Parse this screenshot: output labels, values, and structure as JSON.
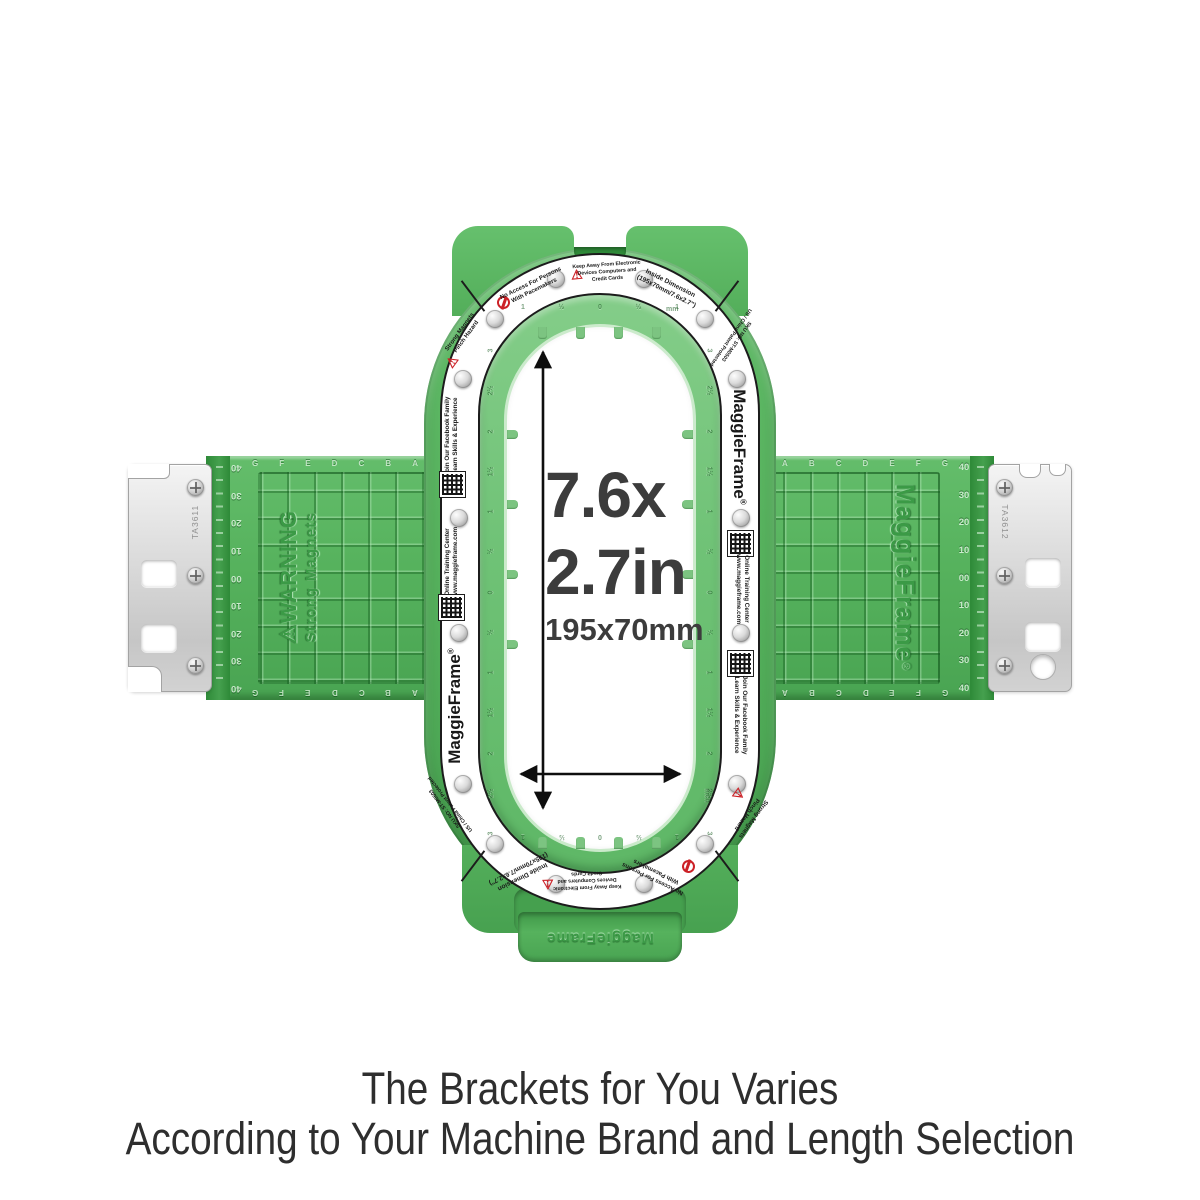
{
  "brand": "MaggieFrame",
  "reg": "®",
  "center_dimensions": {
    "line1": "7.6x",
    "line2": "2.7in",
    "line3": "195x70mm"
  },
  "caption": {
    "line1": "The Brackets for You Varies",
    "line2": "According to Your Machine Brand and Length Selection"
  },
  "ring": {
    "no_access": "No Access For Persons\nWith Pacemakers",
    "keep_away": "Keep Away From Electronic\nDevices Computers and\nCredit Cards",
    "inside_dimension": "Inside Dimension\n(195x70mm/7.6x2.7\")",
    "strong_magnets": "Strong Magnets\nPinch Hazard",
    "sku": "SKU NO: ST-M0503\nUS / China Patent Protected",
    "facebook": "Join Our Facebook Family\nLearn Skills & Experience",
    "training": "Online Training Center\nwww.maggieframe.com"
  },
  "lip_ruler": {
    "top": [
      "1",
      "½",
      "0",
      "½",
      "1"
    ],
    "bottom": [
      "1",
      "½",
      "0",
      "½",
      "1"
    ],
    "side": [
      "3",
      "2½",
      "2",
      "1½",
      "1",
      "½",
      "0",
      "½",
      "1",
      "1½",
      "2",
      "2½",
      "3"
    ],
    "unit_top": "mm",
    "unit_side": "inch"
  },
  "arms": {
    "warning_title": "WARNING",
    "warning_sub": "Strong Magnets",
    "ruler": [
      "40",
      "30",
      "20",
      "10",
      "00",
      "10",
      "20",
      "30",
      "40"
    ],
    "letters_left": [
      "G",
      "F",
      "E",
      "D",
      "C",
      "B",
      "A"
    ],
    "letters_right": [
      "A",
      "B",
      "C",
      "D",
      "E",
      "F",
      "G"
    ]
  },
  "brackets": {
    "left": "TA3611",
    "right": "TA3612"
  },
  "icons": {
    "warning_triangle": "⚠",
    "no_access": "circle-slash",
    "qr_code": "checker-pattern",
    "magnet": "metal-circle"
  },
  "colors": {
    "green_main": "#56b25d",
    "green_dark": "#2e8a38",
    "green_lip": "#6fc276",
    "ring_white": "#ffffff",
    "outline_black": "#1c1c1c",
    "metal_silver": "#d6d6d6",
    "warning_red": "#cc2127",
    "text_dark": "#3c3c3c"
  }
}
